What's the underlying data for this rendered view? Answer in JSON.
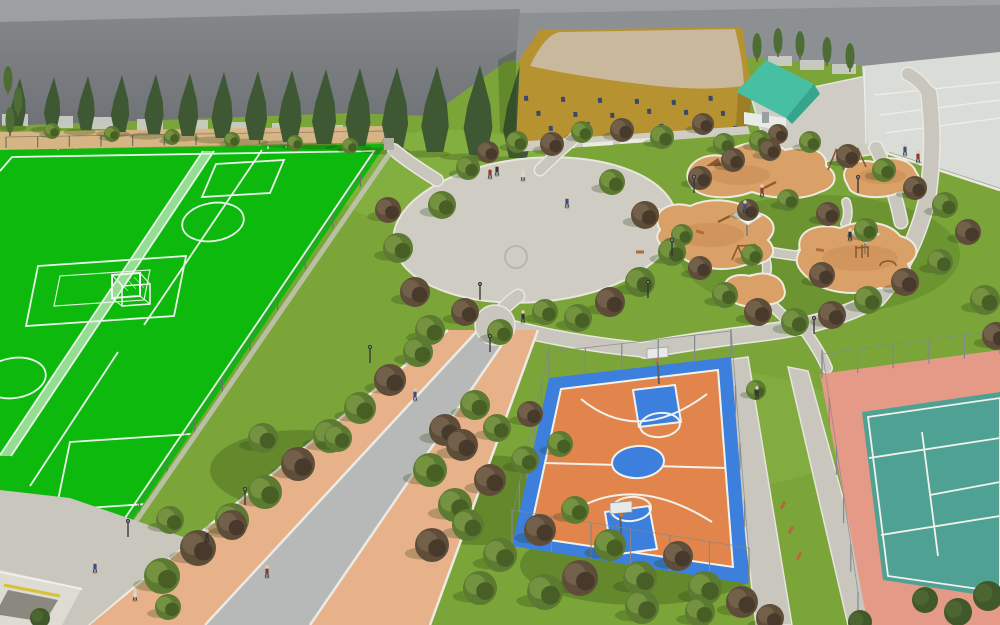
{
  "scene": {
    "title": "Aerial 3D rendering of a sports park master plan",
    "palette": {
      "sky_light": "#9da0a2",
      "sky_dark_top": "#85878a",
      "sky_dark_bottom": "#6f7276",
      "sky_mid": "#8d9092",
      "grass": "#7ba539",
      "grass_light": "#8fba4a",
      "grass_shadow": "rgba(30,55,10,0.25)",
      "field_green": "#0eb90e",
      "field_line": "#e9f4e9",
      "tan_band": "#dcb488",
      "cypress": "#3d5833",
      "poplar": "#4e6d35",
      "bush": "#41582b",
      "trunk": "#7a5a3a",
      "tree_olive_main": "#5c7a31",
      "tree_olive_light": "#74923f",
      "tree_olive_dark": "#475f25",
      "tree_plum_main": "#5e4d39",
      "tree_plum_light": "#72604a",
      "tree_plum_dark": "#483a2b",
      "path_fill": "#c9c6bd",
      "path_curb": "#e9e7df",
      "plaza": "#cfccc4",
      "prom_sand": "#e7b189",
      "prom_gray": "#b6b9b7",
      "prom_curb": "#ecebe3",
      "pg_sand": "#d9a067",
      "pg_sand_dark": "#c98f56",
      "pg_edge": "#ecebe0",
      "bb_blue": "#3c7fdd",
      "bb_orange": "#e2854d",
      "court_line": "#f2f2ec",
      "tn_pink": "#e49a87",
      "tn_teal": "#4fa293",
      "gym_wall": "#b79231",
      "gym_wall_dark": "#9d7d26",
      "gym_roof": "#c9b89c",
      "gym_window": "#3a4a66",
      "pav_roof": "#47bfa3",
      "pav_roof_dark": "#35a58b",
      "pav_wall": "#e9ebe7",
      "parking": "#d9dcd7",
      "parking_line": "#f1f3ef",
      "bench": "#b5683a",
      "equip": "#8a5a30",
      "canopy": "#f3f5f3",
      "lamp": "#2f3235",
      "fence": "#82888c",
      "fence_dark": "#6d7268",
      "goal_white": "#f4f4f0",
      "struct_wall": "#dddbd2",
      "struct_dark": "#8a887f",
      "struct_stripe": "#d8c13a"
    },
    "people_colors": [
      "#3a4f86",
      "#33343c",
      "#d8d8d4",
      "#8c3b34"
    ],
    "trees": {
      "deciduous": [
        [
          52,
          131,
          8,
          "o"
        ],
        [
          112,
          134,
          8,
          "o"
        ],
        [
          172,
          137,
          8,
          "o"
        ],
        [
          232,
          140,
          8,
          "o"
        ],
        [
          295,
          143,
          8,
          "o"
        ],
        [
          350,
          146,
          8,
          "o"
        ],
        [
          418,
          352,
          15,
          "o"
        ],
        [
          390,
          380,
          16,
          "p"
        ],
        [
          360,
          408,
          16,
          "o"
        ],
        [
          330,
          436,
          17,
          "o"
        ],
        [
          298,
          464,
          17,
          "p"
        ],
        [
          265,
          492,
          17,
          "o"
        ],
        [
          232,
          520,
          17,
          "o"
        ],
        [
          198,
          548,
          18,
          "p"
        ],
        [
          162,
          576,
          18,
          "o"
        ],
        [
          263,
          438,
          15,
          "o"
        ],
        [
          338,
          438,
          14,
          "o"
        ],
        [
          170,
          520,
          14,
          "o"
        ],
        [
          232,
          525,
          15,
          "p"
        ],
        [
          445,
          430,
          16,
          "p"
        ],
        [
          475,
          405,
          15,
          "o"
        ],
        [
          430,
          470,
          17,
          "o"
        ],
        [
          462,
          445,
          16,
          "p"
        ],
        [
          497,
          428,
          14,
          "o"
        ],
        [
          530,
          414,
          13,
          "p"
        ],
        [
          455,
          505,
          17,
          "o"
        ],
        [
          490,
          480,
          16,
          "p"
        ],
        [
          525,
          460,
          14,
          "o"
        ],
        [
          560,
          444,
          13,
          "o"
        ],
        [
          432,
          545,
          17,
          "p"
        ],
        [
          468,
          525,
          16,
          "o"
        ],
        [
          500,
          555,
          17,
          "o"
        ],
        [
          540,
          530,
          16,
          "p"
        ],
        [
          575,
          510,
          14,
          "o"
        ],
        [
          610,
          545,
          16,
          "o"
        ],
        [
          580,
          578,
          18,
          "p"
        ],
        [
          545,
          592,
          18,
          "o"
        ],
        [
          640,
          578,
          17,
          "o"
        ],
        [
          678,
          556,
          15,
          "p"
        ],
        [
          705,
          588,
          17,
          "o"
        ],
        [
          742,
          602,
          16,
          "p"
        ],
        [
          642,
          607,
          17,
          "o"
        ],
        [
          480,
          588,
          17,
          "o"
        ],
        [
          168,
          607,
          13,
          "o"
        ],
        [
          398,
          248,
          15,
          "o"
        ],
        [
          415,
          292,
          15,
          "p"
        ],
        [
          442,
          205,
          14,
          "o"
        ],
        [
          468,
          168,
          12,
          "o"
        ],
        [
          430,
          330,
          15,
          "o"
        ],
        [
          465,
          312,
          14,
          "p"
        ],
        [
          500,
          332,
          13,
          "o"
        ],
        [
          388,
          210,
          13,
          "p"
        ],
        [
          612,
          182,
          13,
          "o"
        ],
        [
          645,
          215,
          14,
          "p"
        ],
        [
          672,
          252,
          14,
          "o"
        ],
        [
          640,
          282,
          15,
          "o"
        ],
        [
          610,
          302,
          15,
          "p"
        ],
        [
          578,
          318,
          14,
          "o"
        ],
        [
          545,
          312,
          13,
          "o"
        ],
        [
          488,
          152,
          11,
          "p"
        ],
        [
          517,
          142,
          11,
          "o"
        ],
        [
          552,
          144,
          12,
          "p"
        ],
        [
          582,
          132,
          11,
          "o"
        ],
        [
          622,
          130,
          12,
          "p"
        ],
        [
          662,
          137,
          12,
          "o"
        ],
        [
          703,
          124,
          11,
          "p"
        ],
        [
          724,
          144,
          11,
          "o"
        ],
        [
          760,
          141,
          11,
          "o"
        ],
        [
          778,
          134,
          10,
          "p"
        ],
        [
          700,
          178,
          12,
          "p"
        ],
        [
          733,
          160,
          12,
          "p"
        ],
        [
          770,
          150,
          11,
          "p"
        ],
        [
          810,
          142,
          11,
          "o"
        ],
        [
          848,
          156,
          12,
          "p"
        ],
        [
          884,
          170,
          12,
          "o"
        ],
        [
          915,
          188,
          12,
          "p"
        ],
        [
          945,
          205,
          13,
          "o"
        ],
        [
          968,
          232,
          13,
          "p"
        ],
        [
          940,
          262,
          13,
          "o"
        ],
        [
          905,
          282,
          14,
          "p"
        ],
        [
          868,
          300,
          14,
          "o"
        ],
        [
          832,
          315,
          14,
          "p"
        ],
        [
          795,
          322,
          14,
          "o"
        ],
        [
          758,
          312,
          14,
          "p"
        ],
        [
          725,
          295,
          13,
          "o"
        ],
        [
          700,
          268,
          12,
          "p"
        ],
        [
          682,
          235,
          11,
          "o"
        ],
        [
          748,
          210,
          11,
          "p"
        ],
        [
          788,
          200,
          11,
          "o"
        ],
        [
          828,
          214,
          12,
          "p"
        ],
        [
          866,
          230,
          12,
          "o"
        ],
        [
          822,
          275,
          13,
          "p"
        ],
        [
          752,
          255,
          11,
          "o"
        ],
        [
          985,
          300,
          15,
          "o"
        ],
        [
          996,
          336,
          14,
          "p"
        ],
        [
          756,
          390,
          10,
          "o"
        ],
        [
          700,
          612,
          15,
          "o"
        ],
        [
          770,
          618,
          14,
          "p"
        ]
      ],
      "cypresses": [
        [
          18,
          126,
          48
        ],
        [
          52,
          128,
          51
        ],
        [
          86,
          130,
          54
        ],
        [
          120,
          132,
          57
        ],
        [
          154,
          134,
          60
        ],
        [
          188,
          136,
          63
        ],
        [
          222,
          138,
          66
        ],
        [
          256,
          140,
          69
        ],
        [
          290,
          142,
          72
        ],
        [
          324,
          144,
          75
        ],
        [
          358,
          146,
          78
        ],
        [
          395,
          149,
          82
        ],
        [
          435,
          152,
          86
        ],
        [
          478,
          155,
          90
        ],
        [
          518,
          158,
          93
        ]
      ],
      "poplars": [
        [
          757,
          52
        ],
        [
          778,
          47
        ],
        [
          800,
          50
        ],
        [
          827,
          56
        ],
        [
          850,
          62
        ],
        [
          8,
          85
        ],
        [
          18,
          106
        ],
        [
          10,
          126
        ]
      ],
      "bushes": [
        [
          925,
          600,
          13
        ],
        [
          958,
          612,
          14
        ],
        [
          988,
          596,
          15
        ],
        [
          860,
          622,
          12
        ],
        [
          40,
          618,
          10
        ]
      ]
    },
    "people": [
      [
        95,
        572,
        0
      ],
      [
        135,
        600,
        2
      ],
      [
        207,
        541,
        1
      ],
      [
        267,
        577,
        3
      ],
      [
        415,
        400,
        0
      ],
      [
        523,
        322,
        1
      ],
      [
        490,
        178,
        3
      ],
      [
        523,
        180,
        2
      ],
      [
        567,
        207,
        0
      ],
      [
        497,
        175,
        1
      ],
      [
        745,
        212,
        0
      ],
      [
        762,
        196,
        3
      ],
      [
        850,
        240,
        1
      ],
      [
        905,
        155,
        0
      ],
      [
        918,
        162,
        3
      ],
      [
        757,
        398,
        1
      ]
    ],
    "lamps": [
      [
        128,
        537
      ],
      [
        245,
        505
      ],
      [
        370,
        363
      ],
      [
        490,
        352
      ],
      [
        480,
        300
      ],
      [
        648,
        298
      ],
      [
        672,
        256
      ],
      [
        694,
        193
      ],
      [
        814,
        334
      ],
      [
        858,
        193
      ]
    ],
    "benches": [
      [
        783,
        505,
        -62
      ],
      [
        791,
        530,
        -62
      ],
      [
        799,
        556,
        -62
      ],
      [
        700,
        232,
        15
      ],
      [
        820,
        250,
        8
      ],
      [
        640,
        252,
        0
      ]
    ],
    "canopies": [
      [
        746,
        218
      ],
      [
        864,
        236
      ]
    ],
    "tree_pits": [
      [
        263,
        438
      ],
      [
        338,
        438
      ],
      [
        170,
        520
      ],
      [
        232,
        525
      ]
    ]
  }
}
